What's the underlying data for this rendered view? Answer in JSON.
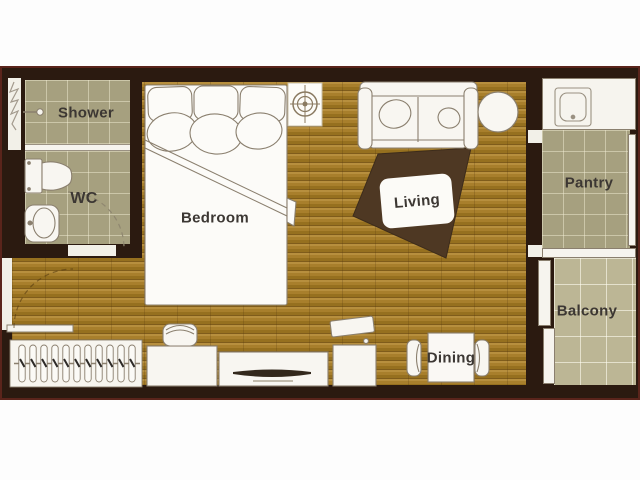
{
  "floorplan": {
    "rooms": {
      "shower": {
        "label": "Shower"
      },
      "wc": {
        "label": "WC"
      },
      "bedroom": {
        "label": "Bedroom"
      },
      "living": {
        "label": "Living"
      },
      "pantry": {
        "label": "Pantry"
      },
      "balcony": {
        "label": "Balcony"
      },
      "dining": {
        "label": "Dining"
      }
    },
    "furniture_icons": [
      "double-bed-icon",
      "headboard-cushion-icon",
      "pillow-icon",
      "sofa-icon",
      "throw-pillow-icon",
      "area-rug-icon",
      "side-table-icon",
      "ceiling-light-icon",
      "shower-head-icon",
      "toilet-icon",
      "washbasin-icon",
      "glass-partition-icon",
      "duct-shaft-icon",
      "kitchen-sink-icon",
      "counter-icon",
      "sliding-door-icon",
      "window-icon",
      "entry-door-icon",
      "door-swing-arc-icon",
      "wardrobe-hangers-icon",
      "desk-icon",
      "stool-icon",
      "tv-console-icon",
      "tv-icon",
      "top-load-appliance-icon",
      "dining-table-icon",
      "dining-chair-icon"
    ],
    "colors": {
      "wall": "#2b1a10",
      "outer_line": "#5a241b",
      "wood_floor": "#a87f2c",
      "bathroom_tile": "#a6a07f",
      "balcony_tile": "#bcb695",
      "rug": "#4e3823",
      "fixture_fill": "#f7f5ef",
      "fixture_stroke": "#8a7f6e",
      "label_text": "#3c3733",
      "page_background": "#ffffff"
    }
  }
}
